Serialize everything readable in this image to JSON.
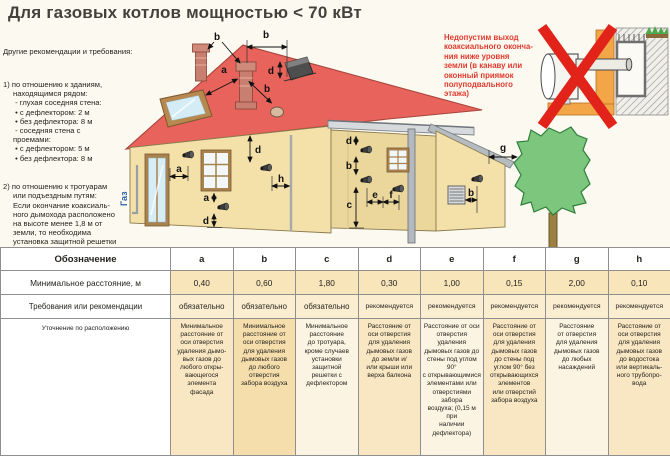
{
  "title": "Для газовых котлов мощностью < 70 кВт",
  "recommendations": {
    "heading": "Другие рекомендации и требования:",
    "item1": "1) по отношению к зданиям,\nнаходящимся рядом:\n - глухая соседняя стена:\n • с дефлектором: 2 м\n • без дефлектора: 8 м\n - соседняя стена с\nпроемами:\n • с дефлектором: 5 м\n • без дефлектора: 8 м",
    "item2": "2) по отношению к тротуарам\nили подъездным путям:\nЕсли окончание коаксиаль-\nного дымохода расположено\nна высоте менее 1,8 м от\nземли, то необходима\nустановка защитной решетки\nс дефлектором."
  },
  "warning": {
    "text": "Недопустим выход\nкоаксиального оконча-\nния ниже уровня\nземли (в канаву или\nоконный приямок\nполуподвального\nэтажа)"
  },
  "diagram": {
    "labels": {
      "gas": "Газ",
      "b1": "b",
      "b2": "b",
      "a1": "a",
      "b3": "b",
      "d_dormer": "d",
      "a2": "a",
      "d1": "d",
      "h1": "h",
      "a3": "a",
      "d2": "d",
      "d3": "d",
      "b4": "b",
      "c1": "c",
      "e1": "e",
      "f1": "f",
      "b5": "b",
      "g1": "g"
    }
  },
  "table": {
    "designation_label": "Обозначение",
    "distance_label": "Минимальное расстояние, м",
    "requirement_label": "Требования или рекомендации",
    "clarification_label": "Уточнение по расположению",
    "columns": [
      {
        "letter": "a",
        "distance": "0,40",
        "requirement": "обязательно",
        "bg": "#F8E7C2",
        "clarification": "Минимальное\nрасстояние от\nоси отверстия\nудаления дымо-\nвых газов до\nлюбого откры-\nвающегося\nэлемента\nфасада"
      },
      {
        "letter": "b",
        "distance": "0,60",
        "requirement": "обязательно",
        "bg": "#F5DEAC",
        "clarification": "Минимальное\nрасстояние от\nоси отверстия\nдля удаления\nдымовых газов\nдо любого\nотверстия\nзабора воздуха"
      },
      {
        "letter": "c",
        "distance": "1,80",
        "requirement": "обязательно",
        "bg": "#FCF4E2",
        "clarification": "Минимальное\nрасстояние\nдо тротуара,\nкроме случаев\nустановки\nзащитной\nрешетки с\nдефлектором"
      },
      {
        "letter": "d",
        "distance": "0,30",
        "requirement": "рекомендуется",
        "bg": "#F8E7C2",
        "clarification": "Расстояние от\nоси отверстия\nдля удаления\nдымовых газов\nдо земли и/\nили крыши или\nверха балкона"
      },
      {
        "letter": "e",
        "distance": "1,00",
        "requirement": "рекомендуется",
        "bg": "#FCF4E2",
        "clarification": "Расстояние от оси\nотверстия удаления\nдымовых газов до\nстены под углом 90°\nс открывающимися\nэлементами или\nотверстиями забора\nвоздуха; (0,15 м при\nналичии дефлектора)"
      },
      {
        "letter": "f",
        "distance": "0,15",
        "requirement": "рекомендуется",
        "bg": "#F8E7C2",
        "clarification": "Расстояние от\nоси отверстия\nдля удаления\nдымовых газов\nдо стены под\nуглом 90° без\nоткрывающихся\nэлементов\nили отверстий\nзабора воздуха"
      },
      {
        "letter": "g",
        "distance": "2,00",
        "requirement": "рекомендуется",
        "bg": "#FCF4E2",
        "clarification": "Расстояние\nот отверстия\nдля удаления\nдымовых газов\nдо любых\nнасаждений"
      },
      {
        "letter": "h",
        "distance": "0,10",
        "requirement": "рекомендуется",
        "bg": "#F8E7C2",
        "clarification": "Расстояние от\nоси отверстия\nдля удаления\nдымовых газов\nдо водостока\nили вертикаль-\nного трубопро-\nвода"
      }
    ]
  },
  "colors": {
    "page-bg": "#FCFAF0",
    "title": "#43413C",
    "text": "#26241F",
    "warning-red": "#E0392E",
    "gas-blue": "#2B5CA8",
    "table-border": "#8F8F8F",
    "row-values-bg": "#F8E5BA",
    "row-req-bg": "#FAEDD0",
    "roof-red": "#E7635B",
    "wall-cream": "#F4E1AA",
    "wall-shade": "#EBD79C",
    "tree-green": "#7CC67E",
    "cross-red": "#E2231A",
    "orange-wall": "#F2A648"
  }
}
